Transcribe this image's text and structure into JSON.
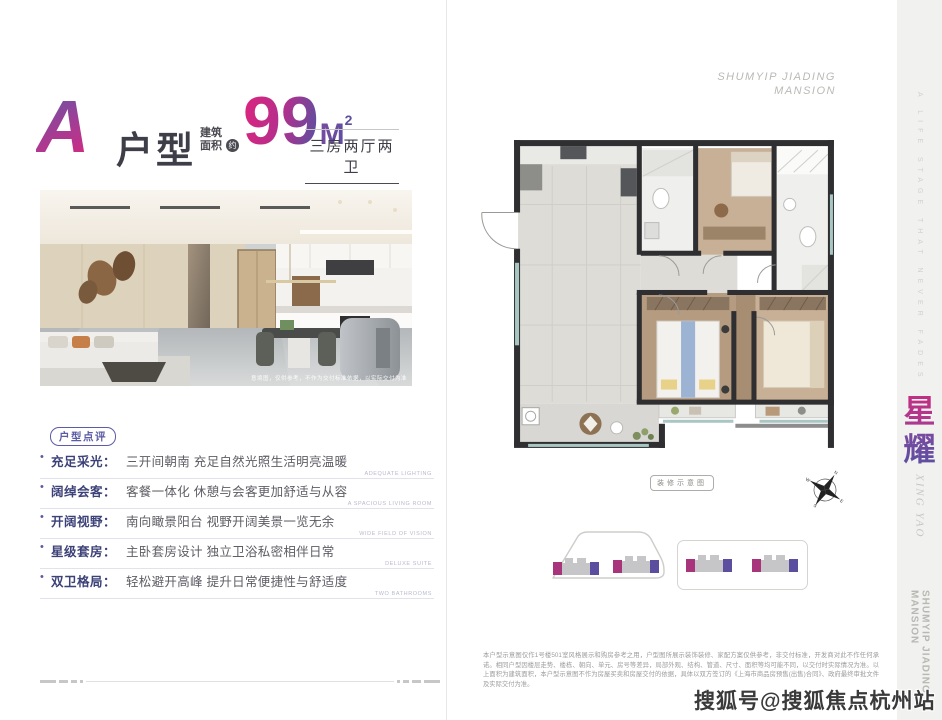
{
  "title": {
    "unit_letter": "A",
    "unit_suffix": "户型",
    "area_prefix_line1": "建筑",
    "area_prefix_line2": "面积",
    "area_circle": "约",
    "area_number": "99",
    "area_unit": "M",
    "area_exp": "2",
    "layout": "三房两厅两卫"
  },
  "photo": {
    "caption": "意境图，仅供参考，不作为交付标准依据，以实际交付为准"
  },
  "review": {
    "badge": "户型点评",
    "items": [
      {
        "label": "充足采光：",
        "desc": "三开间朝南 充足自然光照生活明亮温暖",
        "en": "ADEQUATE LIGHTING"
      },
      {
        "label": "阔绰会客：",
        "desc": "客餐一体化 休憩与会客更加舒适与从容",
        "en": "A SPACIOUS LIVING ROOM"
      },
      {
        "label": "开阔视野：",
        "desc": "南向瞰景阳台 视野开阔美景一览无余",
        "en": "WIDE FIELD OF VISION"
      },
      {
        "label": "星级套房：",
        "desc": "主卧套房设计 独立卫浴私密相伴日常",
        "en": "DELUXE SUITE"
      },
      {
        "label": "双卫格局：",
        "desc": "轻松避开高峰 提升日常便捷性与舒适度",
        "en": "TWO BATHROOMS"
      }
    ]
  },
  "brand": {
    "top_line1": "SHUMYIP JIADING",
    "top_line2": "MANSION"
  },
  "plan": {
    "label": "装修示意图",
    "compass": {
      "n": "N",
      "e": "E",
      "s": "S",
      "w": "W"
    }
  },
  "disclaimer": "本户型示意图仅作1号楼501室风格展示和购房参考之用，户型图所展示装饰装修、家配方案仅供参考，非交付标准，开发商对此不作任何承诺。相同户型因楼层走势、楼栋、朝向、单元、房号等差异，局部外观、结构、管道、尺寸、面积等均可能不同，以交付时实际情况为准。以上面积为建筑面积，本户型示意图不作为房屋买卖和房屋交付的依据，具体以双方签订的《上海市商品房预售(出售)合同》、政府最终审批文件及实际交付为准。",
  "sidebar": {
    "tagline": "A LIFE STAGE THAT NEVER FADES",
    "zh_char1": "星",
    "zh_char2": "耀",
    "pinyin": "XING YAO",
    "brand_vertical_line1": "SHUMYIP JIADING",
    "brand_vertical_line2": "MANSION"
  },
  "watermark": "搜狐号@搜狐焦点杭州站",
  "colors": {
    "accent_pink": "#cf2b83",
    "accent_purple": "#5c4fa0",
    "text_dark": "#3e3e48",
    "review_label": "#3c4178",
    "sidebar_bg": "#f1f1ef"
  }
}
